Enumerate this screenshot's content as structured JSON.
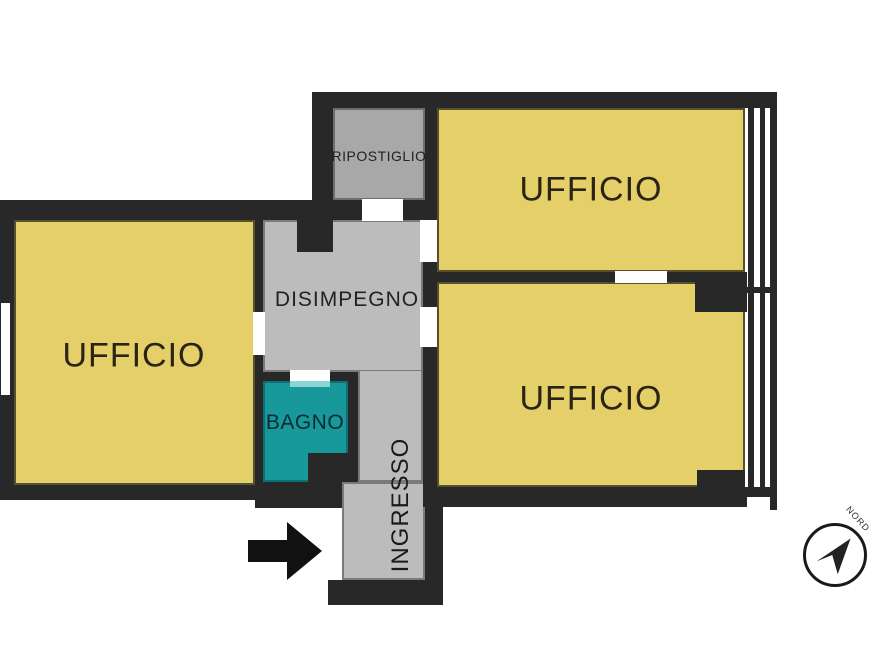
{
  "plan": {
    "rooms": {
      "ufficio_left": {
        "label": "UFFICIO"
      },
      "ufficio_top": {
        "label": "UFFICIO"
      },
      "ufficio_middle": {
        "label": "UFFICIO"
      },
      "ripostiglio": {
        "label": "RIPOSTIGLIO"
      },
      "disimpegno": {
        "label": "DISIMPEGNO"
      },
      "bagno": {
        "label": "BAGNO"
      },
      "ingresso": {
        "label": "INGRESSO"
      }
    },
    "compass": {
      "label": "NORD"
    },
    "icons": {
      "entrance_arrow": "right-arrow",
      "compass_needle": "northeast-navigation-arrow"
    },
    "colors": {
      "wall": "#282828",
      "room_yellow": "#e5cf69",
      "hallway_gray": "#bcbcbc",
      "storage_gray": "#a8a8a8",
      "bagno_teal": "#17999b",
      "bagno_threshold": "#8fd4d4",
      "label_ink": "#2b2416",
      "arrow_black": "#111111"
    }
  }
}
